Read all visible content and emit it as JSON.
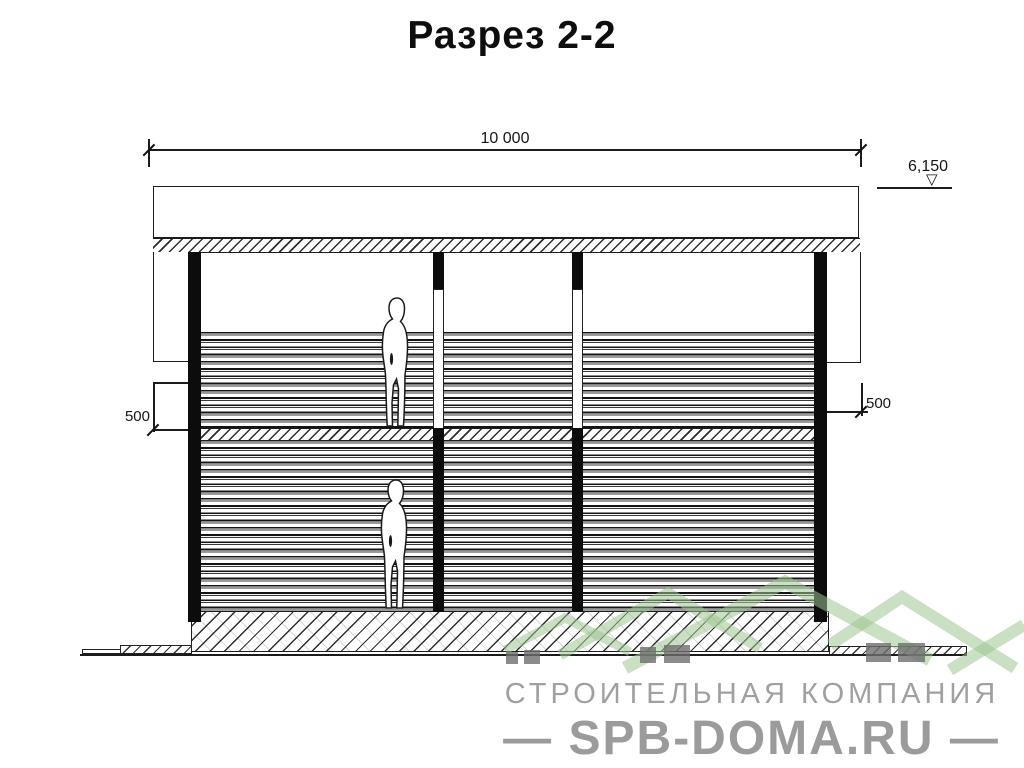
{
  "title": "Разрез 2-2",
  "dimensions": {
    "overall_width": "10 000",
    "ridge_level": "6,150",
    "level_mark_icon": "▽",
    "left_eave_offset": "500",
    "right_eave_offset": "500"
  },
  "watermark": {
    "company": "СТРОИТЕЛЬНАЯ КОМПАНИЯ",
    "site": "— SPB-DOMA.RU —"
  },
  "colors": {
    "drawing_line": "#1c1c1c",
    "watermark_green": "#9cc690",
    "watermark_gray": "#9b9b9b",
    "chimney_gray": "#6e6e6e"
  }
}
